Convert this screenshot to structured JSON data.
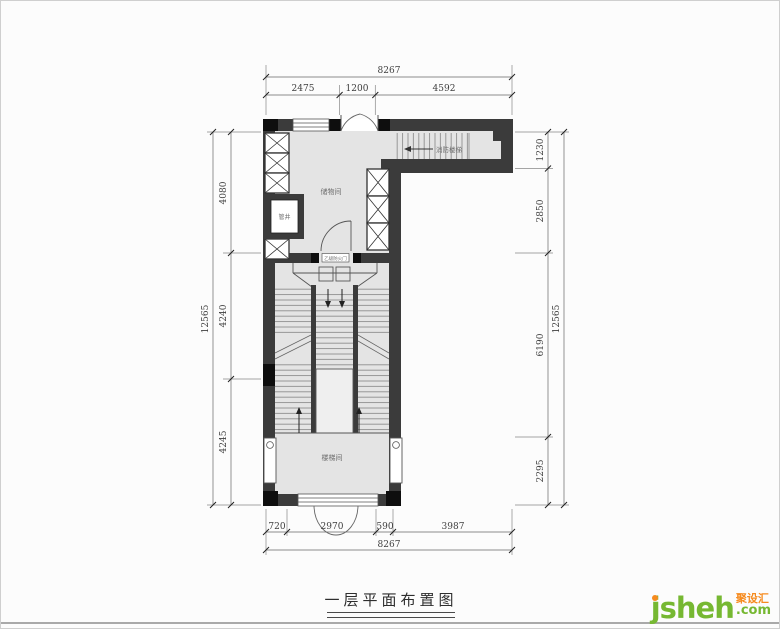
{
  "title": "一层平面布置图",
  "watermark": {
    "brand": "jsheh",
    "suffix": ".com",
    "badge": "聚设汇"
  },
  "labels": {
    "storage_room": "储物间",
    "pipe_shaft": "管井",
    "stair_hall": "楼梯间",
    "fire_stairs": "消防楼梯",
    "entry_door_tag": "乙级防火门"
  },
  "dimensions": {
    "top": {
      "overall": "8267",
      "segments": [
        "2475",
        "1200",
        "4592"
      ]
    },
    "bottom": {
      "overall": "8267",
      "segments": [
        "720",
        "2970",
        "590",
        "3987"
      ]
    },
    "left": {
      "overall": "12565",
      "segments": [
        "4080",
        "4240",
        "4245"
      ]
    },
    "right": {
      "overall": "12565",
      "segments": [
        "1230",
        "2850",
        "6190",
        "2295"
      ]
    }
  },
  "colors": {
    "wall": "#3b3b3b",
    "floor": "#e4e4e4",
    "brand_green": "#76b832",
    "brand_orange": "#f68b1f"
  }
}
